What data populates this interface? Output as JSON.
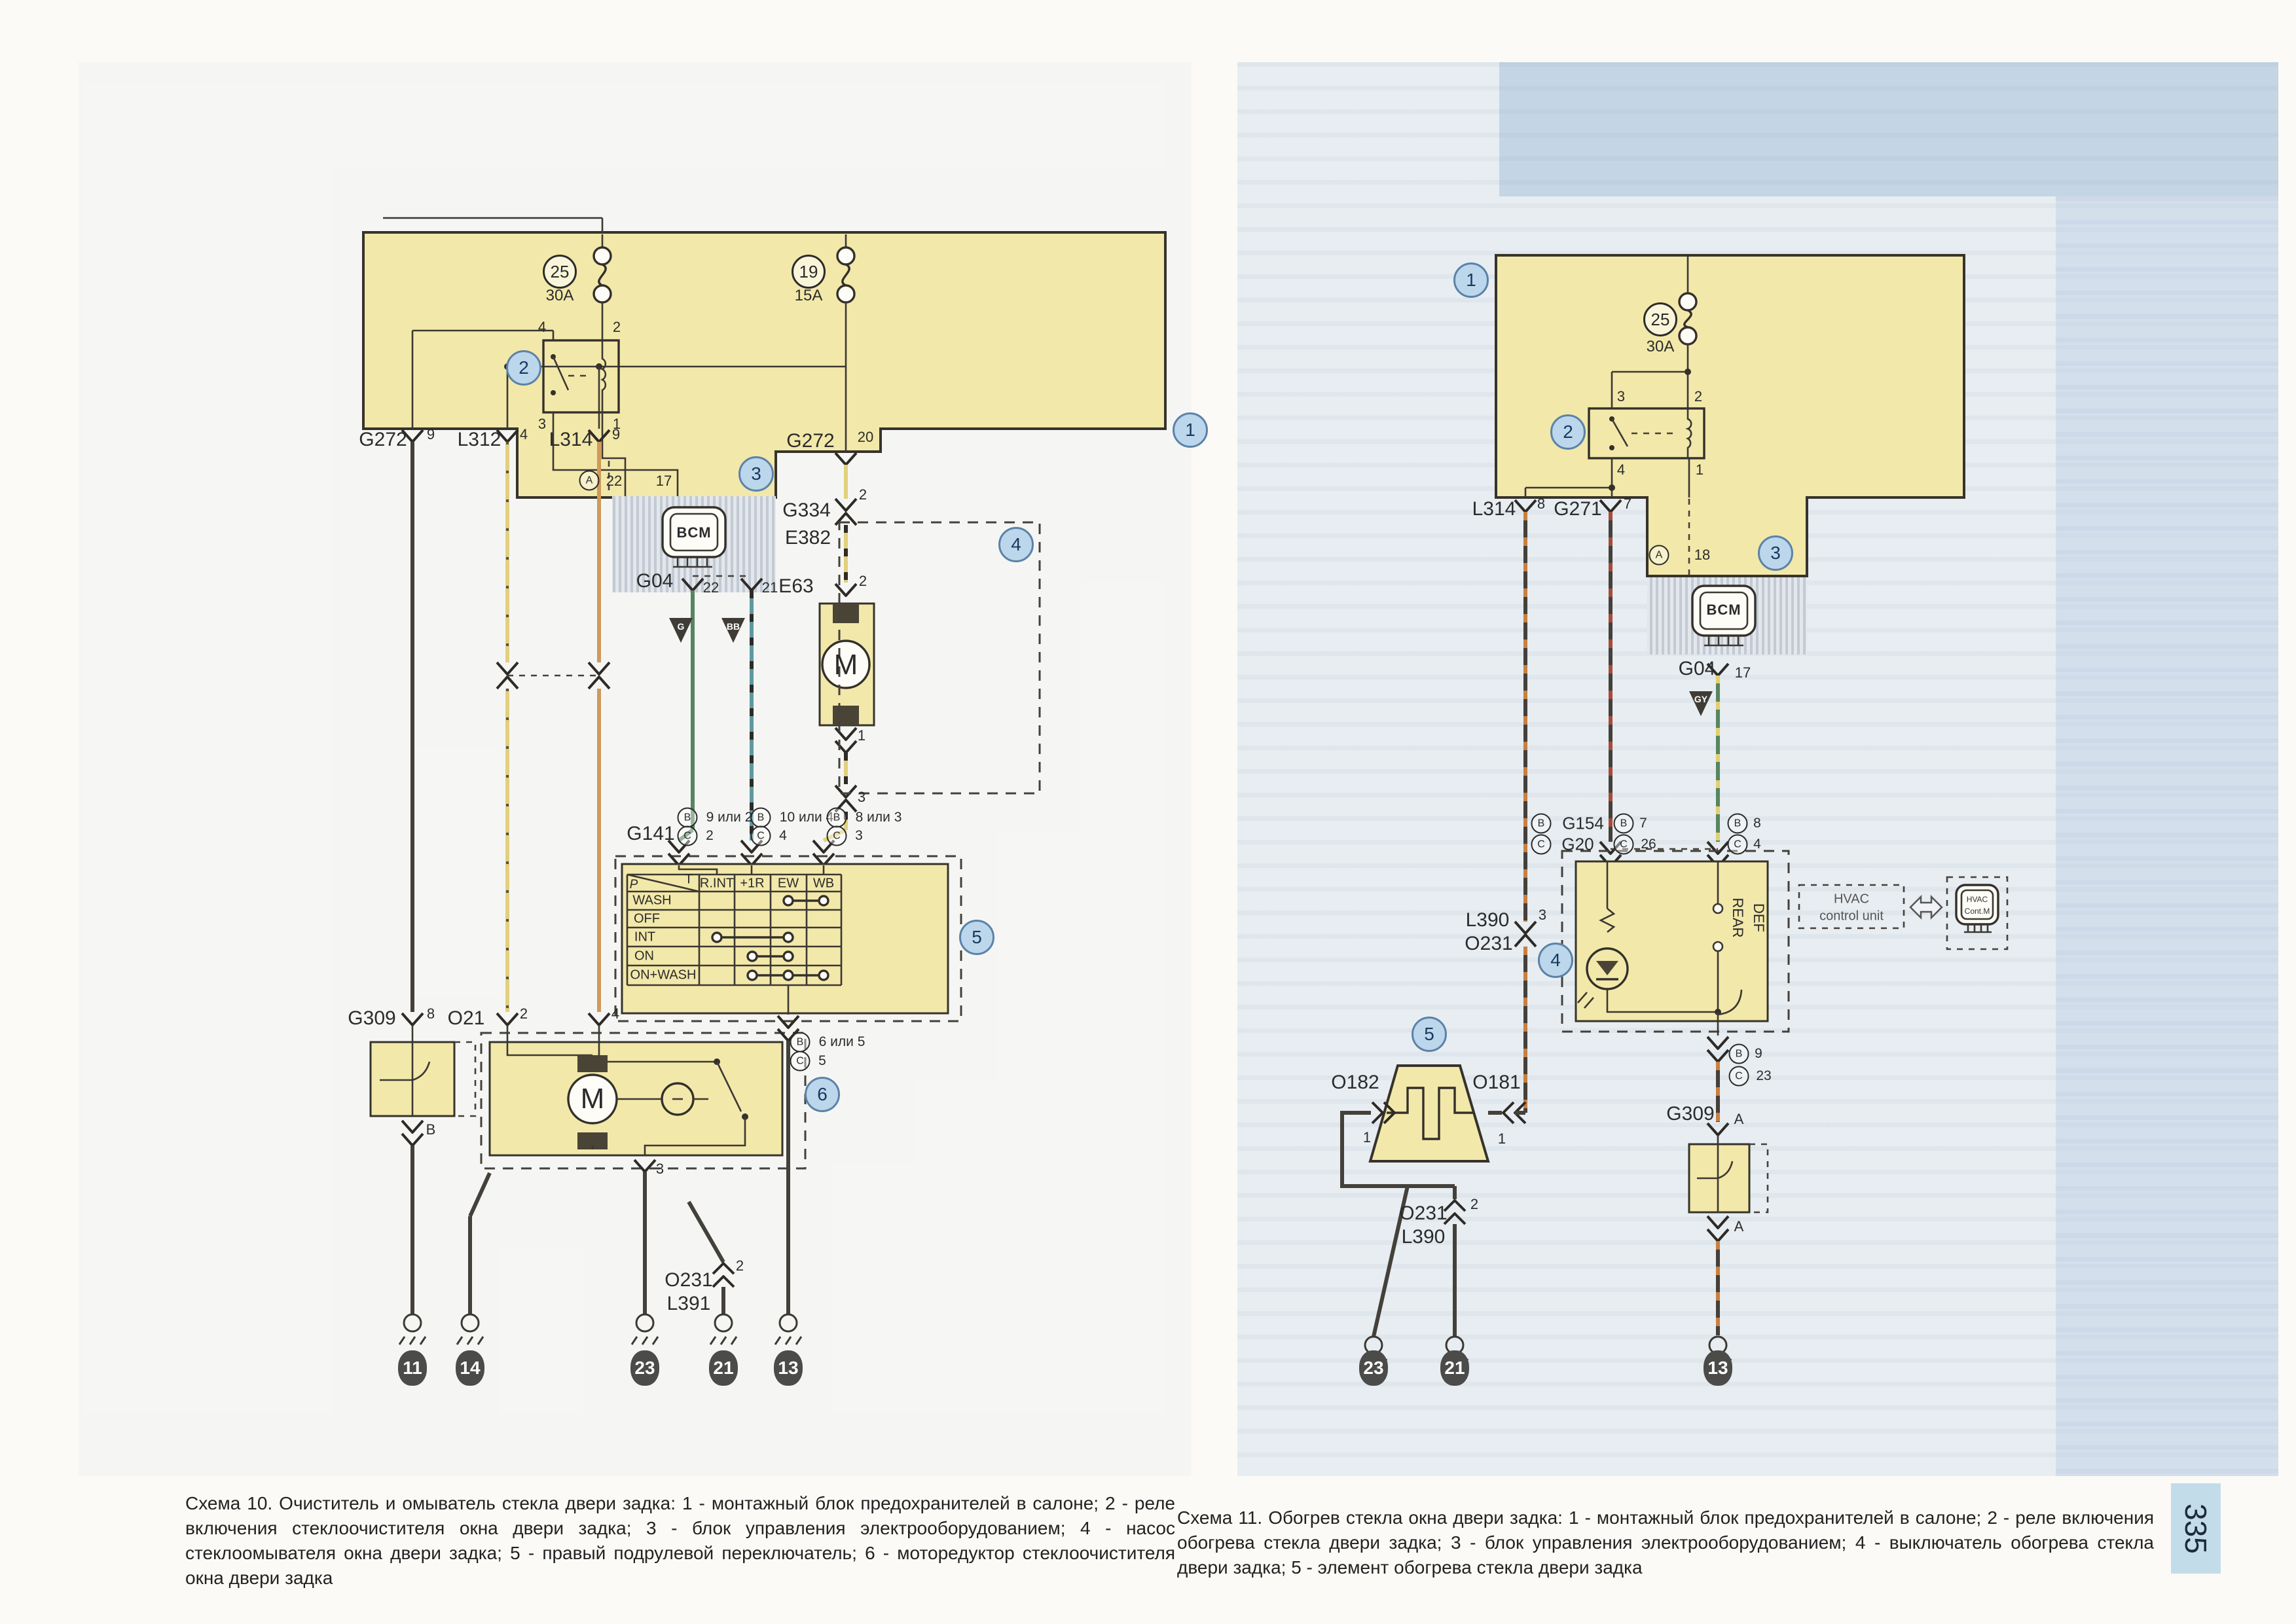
{
  "page": {
    "number": "335"
  },
  "captions": {
    "left": "Схема 10. Очиститель и омыватель стекла двери задка: 1 - монтажный блок предохранителей в салоне; 2 - реле включения стеклоочистителя окна двери задка; 3 - блок управления электрооборудованием; 4 - насос стеклоомывателя окна двери задка; 5 - правый подрулевой переключатель; 6 - моторедуктор стеклоочистителя окна двери задка",
    "right": "Схема 11. Обогрев стекла окна двери задка: 1 - монтажный блок предохранителей в салоне; 2 - реле включения обогрева стекла двери задка; 3 - блок управления электрооборудованием; 4 - выключатель обогрева стекла двери задка; 5 - элемент обогрева стекла двери задка"
  },
  "palette": {
    "paper": "#fbfaf6",
    "block_yellow": "#f2e8aa",
    "blue_badge_bg": "#bcd6ec",
    "blue_badge_border": "#5b82a8",
    "page_tab_bg": "#c3dcea",
    "wire_black": "#44403a",
    "wire_yellow": "#e2d07c",
    "wire_orange": "#cf9a5a",
    "wire_green": "#57855f",
    "wire_teal": "#5e98a0",
    "stripe_red": "#a84a3a",
    "stripe_orange": "#c97f3f"
  },
  "switch_table": {
    "columns": [
      "R.INT",
      "+1R",
      "EW",
      "WB"
    ],
    "rows": [
      "WASH",
      "OFF",
      "INT",
      "ON",
      "ON+WASH"
    ],
    "contacts": {
      "WASH": [
        "EW",
        "WB"
      ],
      "OFF": [],
      "INT": [
        "R.INT",
        "EW"
      ],
      "ON": [
        "+1R",
        "EW"
      ],
      "ON+WASH": [
        "+1R",
        "EW",
        "WB"
      ]
    }
  },
  "labels": [
    [
      "25",
      855,
      415,
      "fnum"
    ],
    [
      "30A",
      855,
      452,
      "amp"
    ],
    [
      "19",
      1235,
      415,
      "fnum"
    ],
    [
      "15A",
      1235,
      452,
      "amp"
    ],
    [
      "2",
      800,
      562,
      "cnum"
    ],
    [
      "1",
      1818,
      657,
      "cnum"
    ],
    [
      "3",
      1155,
      724,
      "cnum"
    ],
    [
      "4",
      1552,
      832,
      "cnum"
    ],
    [
      "5",
      1492,
      1432,
      "cnum"
    ],
    [
      "6",
      1256,
      1672,
      "cnum"
    ],
    [
      "4",
      828,
      500,
      "pin"
    ],
    [
      "2",
      942,
      500,
      "pin"
    ],
    [
      "3",
      828,
      648,
      "pin"
    ],
    [
      "1",
      942,
      648,
      "pin"
    ],
    [
      "G272",
      585,
      672,
      "lbl"
    ],
    [
      "9",
      658,
      664,
      "pin"
    ],
    [
      "L312",
      732,
      672,
      "lbl"
    ],
    [
      "4",
      800,
      664,
      "pin"
    ],
    [
      "L314",
      872,
      672,
      "lbl"
    ],
    [
      "9",
      941,
      664,
      "pin"
    ],
    [
      "G272",
      1238,
      674,
      "lbl"
    ],
    [
      "20",
      1322,
      668,
      "pin"
    ],
    [
      "A",
      900,
      734,
      "clet"
    ],
    [
      "22",
      938,
      735,
      "pin"
    ],
    [
      "17",
      1014,
      735,
      "pin"
    ],
    [
      "BCM",
      1060,
      814,
      "bcm"
    ],
    [
      "G334",
      1232,
      780,
      "lbl"
    ],
    [
      "2",
      1318,
      756,
      "pin"
    ],
    [
      "E382",
      1234,
      822,
      "lbl"
    ],
    [
      "G04",
      1000,
      888,
      "lbl"
    ],
    [
      "22",
      1086,
      898,
      "pin"
    ],
    [
      "21",
      1176,
      898,
      "pin"
    ],
    [
      "G",
      1040,
      957,
      "tri-txt"
    ],
    [
      "BB",
      1120,
      957,
      "tri-txt"
    ],
    [
      "E63",
      1216,
      896,
      "lbl"
    ],
    [
      "2",
      1318,
      888,
      "pin"
    ],
    [
      "M",
      1292,
      1016,
      "mlet"
    ],
    [
      "1",
      1316,
      1124,
      "pin"
    ],
    [
      "3",
      1316,
      1218,
      "pin"
    ],
    [
      "G141",
      994,
      1274,
      "lbl"
    ],
    [
      "B",
      1050,
      1249,
      "clet"
    ],
    [
      "9 или 2",
      1114,
      1249,
      "small"
    ],
    [
      "C",
      1050,
      1277,
      "clet"
    ],
    [
      "2",
      1084,
      1277,
      "small"
    ],
    [
      "B",
      1162,
      1249,
      "clet"
    ],
    [
      "10 или 4",
      1232,
      1249,
      "small"
    ],
    [
      "C",
      1162,
      1277,
      "clet"
    ],
    [
      "4",
      1196,
      1277,
      "small"
    ],
    [
      "B",
      1278,
      1249,
      "clet"
    ],
    [
      "8 или 3",
      1342,
      1249,
      "small"
    ],
    [
      "C",
      1278,
      1277,
      "clet"
    ],
    [
      "3",
      1312,
      1277,
      "small"
    ],
    [
      "P",
      968,
      1352,
      "tbli"
    ],
    [
      "T",
      1052,
      1344,
      "tbl"
    ],
    [
      "R.INT",
      1095,
      1350,
      "tbl"
    ],
    [
      "+1R",
      1149,
      1350,
      "tbl"
    ],
    [
      "EW",
      1204,
      1350,
      "tbl"
    ],
    [
      "WB",
      1258,
      1350,
      "tbl"
    ],
    [
      "WASH",
      996,
      1376,
      "tbl"
    ],
    [
      "OFF",
      988,
      1404,
      "tbl"
    ],
    [
      "INT",
      985,
      1432,
      "tbl"
    ],
    [
      "ON",
      984,
      1461,
      "tbl"
    ],
    [
      "ON+WASH",
      1013,
      1490,
      "tbl"
    ],
    [
      "B",
      1222,
      1592,
      "clet"
    ],
    [
      "6 или 5",
      1286,
      1592,
      "small"
    ],
    [
      "C",
      1222,
      1621,
      "clet"
    ],
    [
      "5",
      1256,
      1621,
      "small"
    ],
    [
      "G309",
      568,
      1556,
      "lbl"
    ],
    [
      "8",
      658,
      1549,
      "pin"
    ],
    [
      "B",
      658,
      1726,
      "pin"
    ],
    [
      "O21",
      712,
      1556,
      "lbl"
    ],
    [
      "2",
      800,
      1549,
      "pin"
    ],
    [
      "4",
      940,
      1549,
      "pin"
    ],
    [
      "M",
      905,
      1679,
      "mlet"
    ],
    [
      "3",
      1008,
      1786,
      "pin"
    ],
    [
      "O231",
      1052,
      1956,
      "lbl"
    ],
    [
      "L391",
      1052,
      1992,
      "lbl"
    ],
    [
      "2",
      1130,
      1934,
      "pin"
    ],
    [
      "11",
      630,
      2090,
      "badge"
    ],
    [
      "14",
      718,
      2090,
      "badge"
    ],
    [
      "23",
      985,
      2090,
      "badge"
    ],
    [
      "21",
      1105,
      2090,
      "badge"
    ],
    [
      "13",
      1204,
      2090,
      "badge"
    ],
    [
      "1",
      2247,
      428,
      "cnum"
    ],
    [
      "2",
      2395,
      660,
      "cnum"
    ],
    [
      "3",
      2712,
      845,
      "cnum"
    ],
    [
      "4",
      2376,
      1467,
      "cnum"
    ],
    [
      "5",
      2183,
      1580,
      "cnum"
    ],
    [
      "25",
      2536,
      488,
      "fnum"
    ],
    [
      "30A",
      2536,
      530,
      "amp"
    ],
    [
      "3",
      2476,
      606,
      "pin"
    ],
    [
      "2",
      2594,
      606,
      "pin"
    ],
    [
      "4",
      2476,
      718,
      "pin"
    ],
    [
      "1",
      2596,
      718,
      "pin"
    ],
    [
      "L314",
      2282,
      778,
      "lbl"
    ],
    [
      "8",
      2354,
      770,
      "pin"
    ],
    [
      "G271",
      2410,
      778,
      "lbl"
    ],
    [
      "7",
      2486,
      770,
      "pin"
    ],
    [
      "A",
      2534,
      848,
      "clet"
    ],
    [
      "18",
      2600,
      848,
      "pin"
    ],
    [
      "BCM",
      2633,
      932,
      "bcm"
    ],
    [
      "G04",
      2592,
      1022,
      "lbl"
    ],
    [
      "17",
      2662,
      1028,
      "pin"
    ],
    [
      "GY",
      2598,
      1068,
      "tri-txt"
    ],
    [
      "B",
      2354,
      1258,
      "clet"
    ],
    [
      "G154",
      2418,
      1258,
      "lbl2"
    ],
    [
      "C",
      2354,
      1290,
      "clet"
    ],
    [
      "G20",
      2410,
      1290,
      "lbl2"
    ],
    [
      "B",
      2480,
      1258,
      "clet"
    ],
    [
      "7",
      2510,
      1258,
      "small"
    ],
    [
      "C",
      2480,
      1290,
      "clet"
    ],
    [
      "26",
      2518,
      1290,
      "small"
    ],
    [
      "B",
      2654,
      1258,
      "clet"
    ],
    [
      "8",
      2684,
      1258,
      "small"
    ],
    [
      "C",
      2654,
      1290,
      "clet"
    ],
    [
      "4",
      2684,
      1290,
      "small"
    ],
    [
      "L390",
      2272,
      1406,
      "lbl"
    ],
    [
      "O231",
      2274,
      1442,
      "lbl"
    ],
    [
      "3",
      2356,
      1398,
      "pin"
    ],
    [
      "REAR",
      2654,
      1402,
      "vt"
    ],
    [
      "DEF",
      2686,
      1402,
      "vt"
    ],
    [
      "HVAC",
      2828,
      1374,
      "hv"
    ],
    [
      "control unit",
      2828,
      1400,
      "hv"
    ],
    [
      "HVAC",
      3020,
      1374,
      "hvs"
    ],
    [
      "Cont.M",
      3020,
      1392,
      "hvs"
    ],
    [
      "B",
      2656,
      1610,
      "clet"
    ],
    [
      "9",
      2686,
      1610,
      "small"
    ],
    [
      "C",
      2656,
      1644,
      "clet"
    ],
    [
      "23",
      2694,
      1644,
      "small"
    ],
    [
      "O182",
      2070,
      1654,
      "lbl"
    ],
    [
      "1",
      2088,
      1738,
      "pin"
    ],
    [
      "O181",
      2286,
      1654,
      "lbl"
    ],
    [
      "1",
      2294,
      1740,
      "pin"
    ],
    [
      "O231",
      2174,
      1854,
      "lbl"
    ],
    [
      "L390",
      2174,
      1890,
      "lbl"
    ],
    [
      "2",
      2252,
      1840,
      "pin"
    ],
    [
      "G309",
      2582,
      1702,
      "lbl"
    ],
    [
      "A",
      2656,
      1710,
      "pin"
    ],
    [
      "A",
      2656,
      1874,
      "pin"
    ],
    [
      "23",
      2098,
      2090,
      "badge"
    ],
    [
      "21",
      2222,
      2090,
      "badge"
    ],
    [
      "13",
      2624,
      2090,
      "badge"
    ]
  ]
}
